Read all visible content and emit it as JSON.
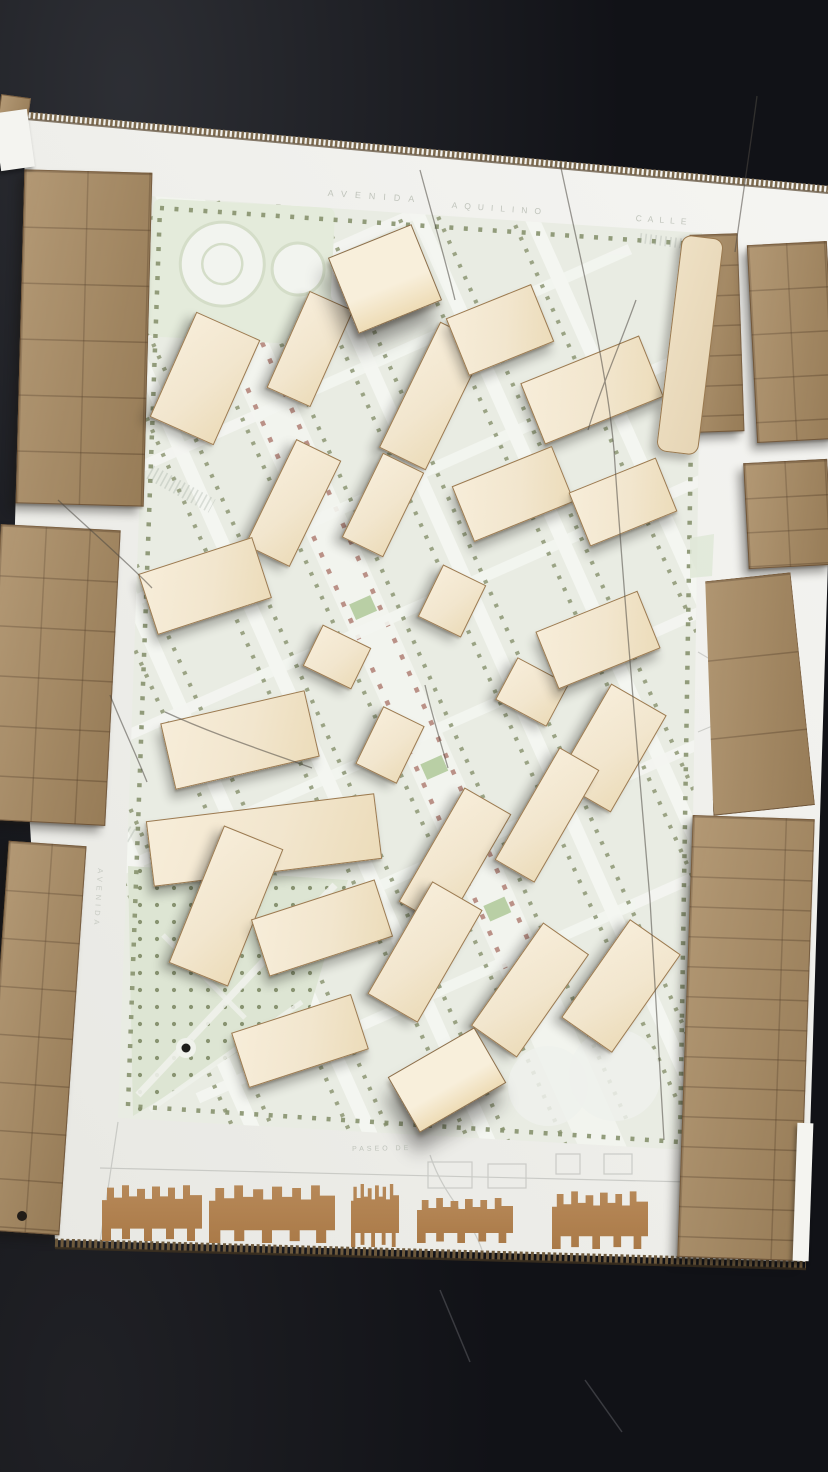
{
  "scene": {
    "description": "Photograph of a physical urban-design massing model: white baseboard with a printed pale-green site plan, light plywood building volumes arranged along a diagonal boulevard, raw cardboard context blocks around the edges, jagged cardboard facade strips along the bottom, all sitting on a dark table."
  },
  "street_labels": [
    {
      "text": "AVENIDA",
      "x": 328,
      "y": 188,
      "rot": 4,
      "spacing": 8,
      "size": 9,
      "vertical": false
    },
    {
      "text": "AQUILINO",
      "x": 452,
      "y": 200,
      "rot": 4,
      "spacing": 7,
      "size": 8.5,
      "vertical": false
    },
    {
      "text": "CALLE",
      "x": 636,
      "y": 213,
      "rot": 4,
      "spacing": 6,
      "size": 8.5,
      "vertical": false
    },
    {
      "text": "AVENIDA",
      "x": 96,
      "y": 868,
      "rot": 4,
      "spacing": 4,
      "size": 7.5,
      "vertical": true
    },
    {
      "text": "PASEO DE",
      "x": 352,
      "y": 1146,
      "rot": -1,
      "spacing": 3,
      "size": 7,
      "vertical": false
    }
  ],
  "colors": {
    "background": "#111217",
    "board": "#f2f2ee",
    "plan_base": "#e9ece3",
    "street": "#f5f7f2",
    "park_green": "#e2e9d8",
    "tree_dot": "#87926e",
    "median_red": "#b5877c",
    "median_green": "#b9cfa5",
    "mdf": "#a88a61",
    "mdf_score_line": "#5a3f24",
    "plywood": "#f2e6ce",
    "plywood_edge": "#96744a",
    "facade_card": "#b28255",
    "corrugated_edge": "#7d6a4e"
  },
  "model": {
    "proposed_blocks": [
      {
        "x": 205,
        "y": 378,
        "w": 70,
        "h": 115,
        "r": 24
      },
      {
        "x": 310,
        "y": 349,
        "w": 48,
        "h": 106,
        "r": 24
      },
      {
        "x": 385,
        "y": 279,
        "w": 90,
        "h": 82,
        "r": -22,
        "kind": "tall"
      },
      {
        "x": 433,
        "y": 396,
        "w": 52,
        "h": 140,
        "r": 26
      },
      {
        "x": 500,
        "y": 330,
        "w": 92,
        "h": 62,
        "r": -22
      },
      {
        "x": 592,
        "y": 390,
        "w": 128,
        "h": 66,
        "r": -22
      },
      {
        "x": 690,
        "y": 345,
        "w": 42,
        "h": 218,
        "r": 7,
        "kind": "sliver"
      },
      {
        "x": 293,
        "y": 503,
        "w": 50,
        "h": 118,
        "r": 26
      },
      {
        "x": 383,
        "y": 505,
        "w": 46,
        "h": 94,
        "r": 26
      },
      {
        "x": 513,
        "y": 494,
        "w": 108,
        "h": 60,
        "r": -22
      },
      {
        "x": 623,
        "y": 502,
        "w": 94,
        "h": 58,
        "r": -22
      },
      {
        "x": 205,
        "y": 586,
        "w": 120,
        "h": 64,
        "r": -18
      },
      {
        "x": 337,
        "y": 657,
        "w": 54,
        "h": 46,
        "r": 26
      },
      {
        "x": 452,
        "y": 601,
        "w": 48,
        "h": 58,
        "r": 26
      },
      {
        "x": 532,
        "y": 692,
        "w": 58,
        "h": 48,
        "r": 28
      },
      {
        "x": 598,
        "y": 640,
        "w": 110,
        "h": 62,
        "r": -22
      },
      {
        "x": 611,
        "y": 748,
        "w": 64,
        "h": 112,
        "r": 30
      },
      {
        "x": 240,
        "y": 740,
        "w": 148,
        "h": 68,
        "r": -13
      },
      {
        "x": 390,
        "y": 745,
        "w": 46,
        "h": 64,
        "r": 26
      },
      {
        "x": 264,
        "y": 840,
        "w": 230,
        "h": 66,
        "r": -7
      },
      {
        "x": 455,
        "y": 858,
        "w": 54,
        "h": 132,
        "r": 30
      },
      {
        "x": 547,
        "y": 815,
        "w": 46,
        "h": 130,
        "r": 30
      },
      {
        "x": 226,
        "y": 906,
        "w": 64,
        "h": 148,
        "r": 22
      },
      {
        "x": 322,
        "y": 928,
        "w": 130,
        "h": 60,
        "r": -18
      },
      {
        "x": 425,
        "y": 952,
        "w": 58,
        "h": 130,
        "r": 30
      },
      {
        "x": 300,
        "y": 1041,
        "w": 126,
        "h": 58,
        "r": -18
      },
      {
        "x": 530,
        "y": 990,
        "w": 56,
        "h": 126,
        "r": 35
      },
      {
        "x": 621,
        "y": 986,
        "w": 62,
        "h": 120,
        "r": 35
      },
      {
        "x": 447,
        "y": 1080,
        "w": 100,
        "h": 64,
        "r": -30,
        "kind": "tall"
      }
    ],
    "context_blocks": [
      {
        "x": 84,
        "y": 338,
        "w": 128,
        "h": 334,
        "r": 1.5,
        "rows": 56,
        "colw": 62
      },
      {
        "x": 53,
        "y": 675,
        "w": 120,
        "h": 296,
        "r": 3,
        "rows": 50,
        "colw": 44
      },
      {
        "x": 34,
        "y": 1038,
        "w": 78,
        "h": 390,
        "r": 4,
        "rows": 48,
        "colw": 42
      },
      {
        "x": 717,
        "y": 333,
        "w": 48,
        "h": 198,
        "r": -2,
        "rows": 30
      },
      {
        "x": 792,
        "y": 342,
        "w": 80,
        "h": 198,
        "r": -3,
        "rows": 44,
        "colw": 38
      },
      {
        "x": 788,
        "y": 514,
        "w": 84,
        "h": 106,
        "r": -3,
        "rows": 34,
        "colw": 40
      },
      {
        "x": 752,
        "y": 694,
        "w": 102,
        "h": 234,
        "r": -6,
        "rows": 78,
        "taper": "16% 0,100% 0,100% 100%,0 100%"
      },
      {
        "x": 746,
        "y": 1038,
        "w": 122,
        "h": 442,
        "r": 2,
        "rows": 30,
        "colw": 92
      },
      {
        "x": 13,
        "y": 118,
        "w": 30,
        "h": 44,
        "r": 8
      }
    ],
    "facade_strips": [
      {
        "x": 152,
        "y": 1210,
        "w": 100,
        "h": 62
      },
      {
        "x": 272,
        "y": 1211,
        "w": 126,
        "h": 64
      },
      {
        "x": 375,
        "y": 1212,
        "w": 48,
        "h": 70
      },
      {
        "x": 465,
        "y": 1218,
        "w": 96,
        "h": 50
      },
      {
        "x": 600,
        "y": 1217,
        "w": 96,
        "h": 64
      }
    ],
    "foam_pieces": [
      {
        "x": 14,
        "y": 140,
        "w": 34,
        "h": 58,
        "r": -8
      },
      {
        "x": 803,
        "y": 1192,
        "w": 16,
        "h": 138,
        "r": 2
      }
    ]
  }
}
